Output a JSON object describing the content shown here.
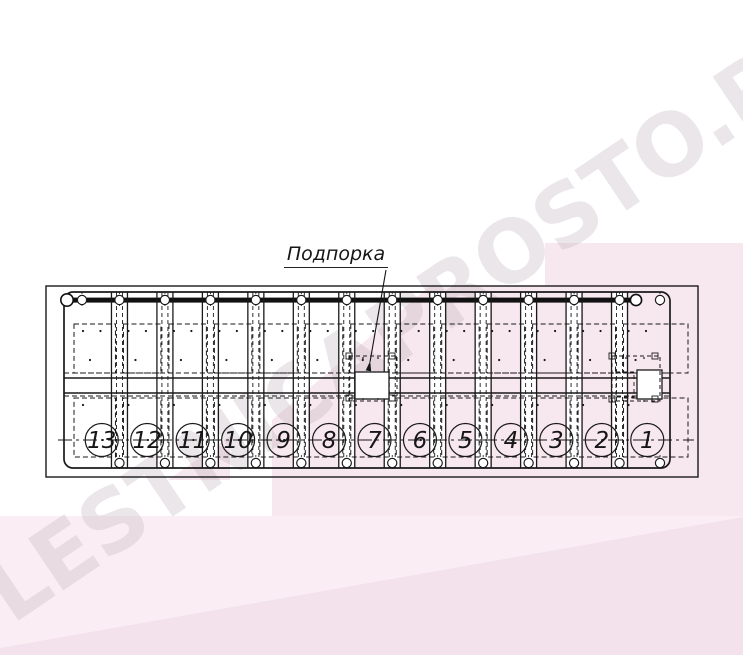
{
  "title": "Staircase plan technical drawing",
  "watermark": {
    "text": "LESTNICAPROSTO.RU"
  },
  "annotation": {
    "label": "Подпорка"
  },
  "drawing": {
    "type": "staircase-plan-view",
    "step_count": 13,
    "step_numbers": [
      "13",
      "12",
      "11",
      "10",
      "9",
      "8",
      "7",
      "6",
      "5",
      "4",
      "3",
      "2",
      "1"
    ],
    "numbering_direction": "right-to-left"
  },
  "colors": {
    "line": "#1a1a1a",
    "background": "#ffffff",
    "pink_overlay": "#f7e7ef",
    "pink_band": "#faeef4",
    "pink_band_dark": "#f3e2eb",
    "watermark_gray": "#bfb0ba"
  }
}
